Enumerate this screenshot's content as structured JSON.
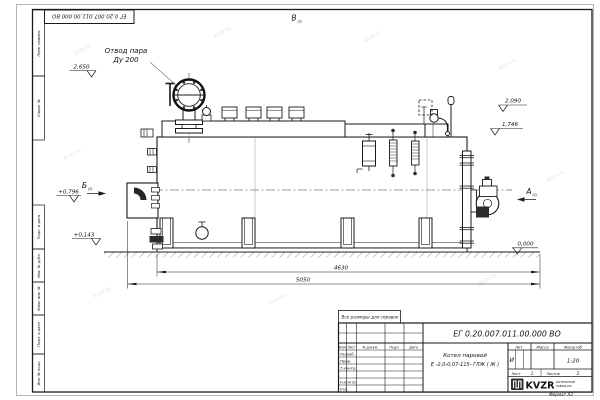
{
  "page": {
    "format": "Формат А3",
    "watermark": "kvzr.ru"
  },
  "margin": {
    "stamp_number": "ЕГ 0.20.007.011.00.000 ВО",
    "cells": [
      "Перв. примен.",
      "Справ. №",
      "Подп. и дата",
      "Инв. № дубл.",
      "Взам. инв. №",
      "Подп. и дата",
      "Инв. № подл."
    ]
  },
  "drawing": {
    "callout": {
      "line1": "Отвод пара",
      "line2": "Ду 200"
    },
    "views": {
      "top": "В",
      "top_ref": "(2)",
      "left": "Б",
      "left_ref": "(2)",
      "right": "А",
      "right_ref": "(2)"
    },
    "elevations": {
      "e1": "2,650",
      "e2": "2,090",
      "e3": "1,746",
      "e4": "+0,796",
      "e5": "+0,143",
      "e6": "0,000"
    },
    "dims": {
      "length_inner": "4630",
      "length_overall": "5050"
    }
  },
  "title_block": {
    "note": "Все размеры для справок",
    "number": "ЕГ 0.20.007.011.00.000  ВО",
    "name1": "Котел паровой",
    "name2": "Е -2,0-0,07-115- ГЛЖ ( Ж )",
    "cols": {
      "izm": "Изм",
      "list": "Лист",
      "doc": "N докум.",
      "sign": "Подп.",
      "date": "Дата"
    },
    "rows": {
      "r1": "Разраб.",
      "r2": "Пров.",
      "r3": "Т.контр.",
      "r4": "Н.контр.",
      "r5": "Утв."
    },
    "lit": {
      "label": "Лит.",
      "value": "И"
    },
    "mass": {
      "label": "Масса"
    },
    "scale": {
      "label": "Масштаб",
      "value": "1:20"
    },
    "sheet": {
      "label": "Лист",
      "value": "1"
    },
    "sheets": {
      "label": "Листов",
      "value": "2"
    },
    "logo": {
      "text": "KVZR",
      "sub1": "КОТЕЛЬНЫЙ",
      "sub2": "ЗАВОД РФ"
    }
  }
}
